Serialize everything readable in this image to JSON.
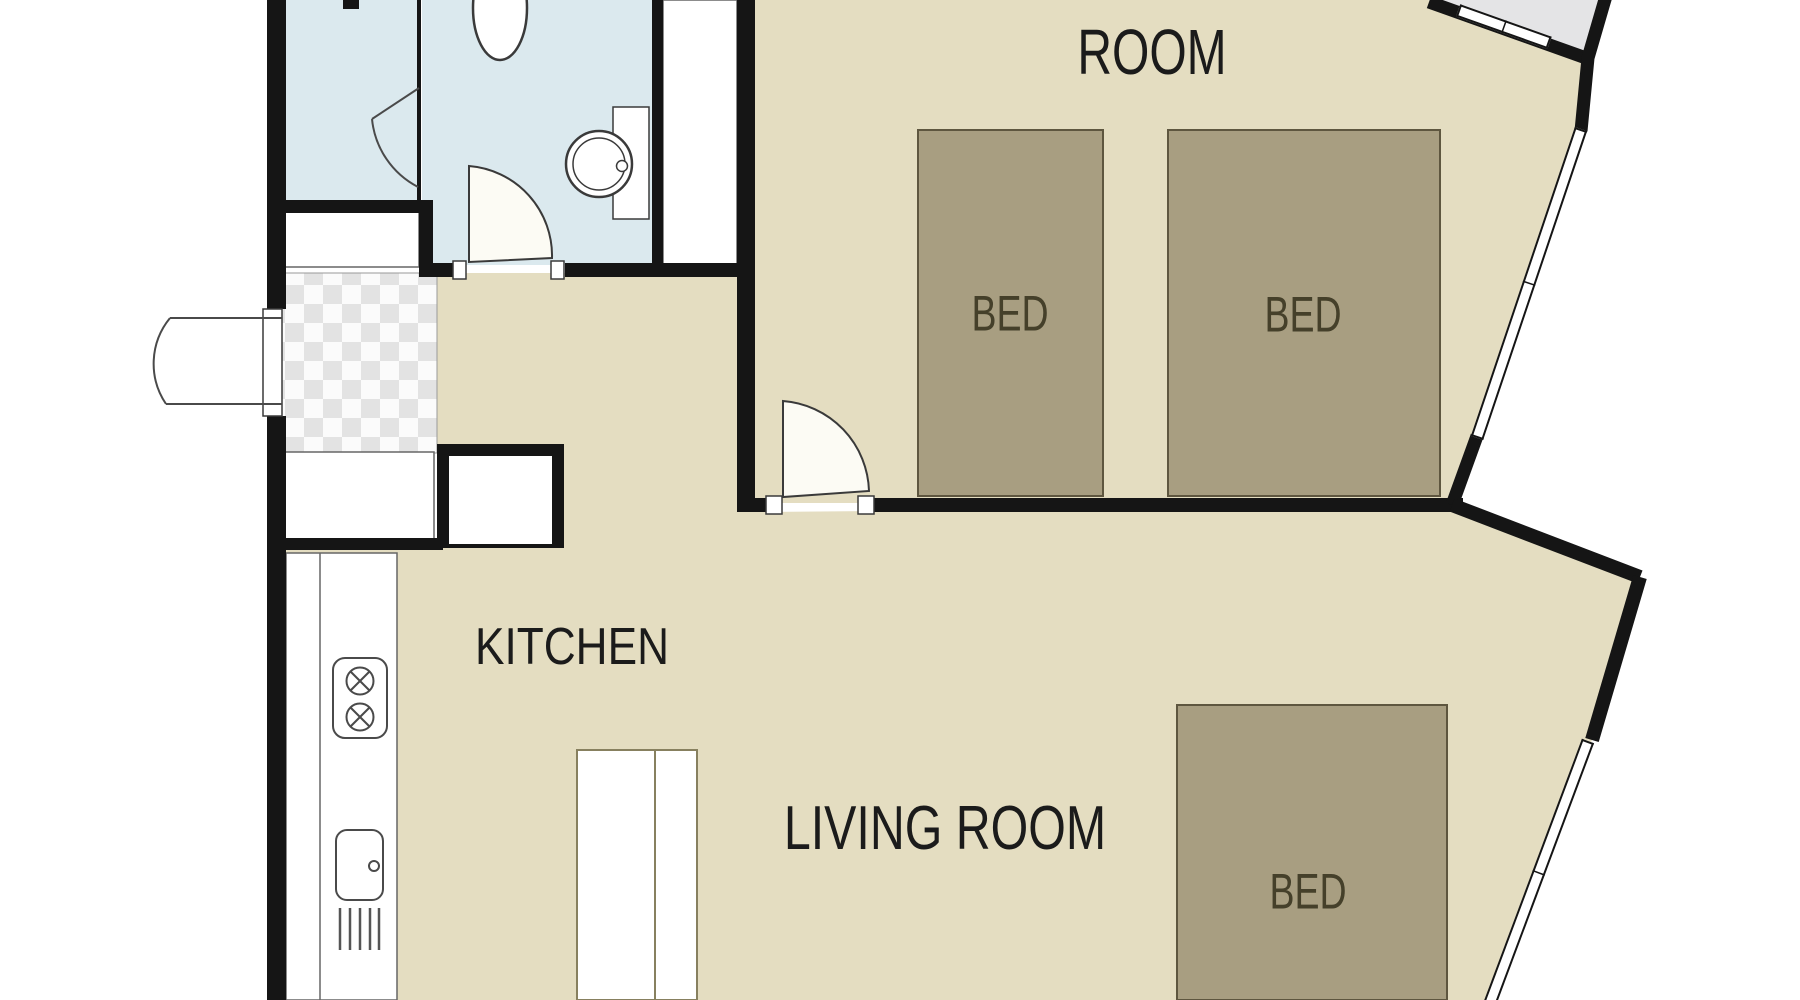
{
  "floorplan": {
    "rooms": {
      "bedroom": {
        "label": "ROOM"
      },
      "kitchen": {
        "label": "KITCHEN"
      },
      "living_room": {
        "label": "LIVING ROOM"
      }
    },
    "furniture": {
      "bed1": {
        "label": "BED"
      },
      "bed2": {
        "label": "BED"
      },
      "bed3": {
        "label": "BED"
      }
    },
    "colors": {
      "floor_tan": "#e4ddc1",
      "bed_fill": "#a89e81",
      "bed_border": "#5e563f",
      "bathroom_blue": "#dbe9ee",
      "balcony_gray": "#e4e4e6",
      "wall_black": "#151515",
      "checker_gray": "#e3e3e3",
      "label_text": "#1b1b1b"
    }
  }
}
